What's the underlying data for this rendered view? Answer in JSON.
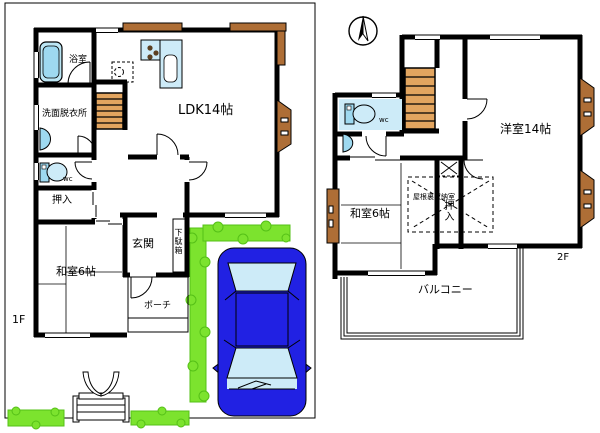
{
  "plan": {
    "floor1": {
      "floor_label": "1F",
      "ldk": "LDK14帖",
      "bath": "浴室",
      "washroom": "洗面脱衣所",
      "wc": "wc",
      "closet": "押入",
      "washitsu": "和室6帖",
      "entrance": "玄関",
      "shoe_cabinet": "下駄箱",
      "porch": "ポーチ"
    },
    "floor2": {
      "floor_label": "2F",
      "western_room": "洋室14帖",
      "washitsu": "和室6帖",
      "wc": "wc",
      "closet": "押入",
      "attic_storage": "屋根裏収納室",
      "balcony": "バルコニー"
    },
    "colors": {
      "wall": "#000000",
      "fixture_light": "#CDEBF8",
      "fixture_deep": "#9ED9F0",
      "stairs": "#E3A55F",
      "wood_trim": "#AE6E36",
      "hedge": "#7CE32E",
      "car_body": "#2121E3",
      "car_glass": "#CDEBF8"
    }
  }
}
